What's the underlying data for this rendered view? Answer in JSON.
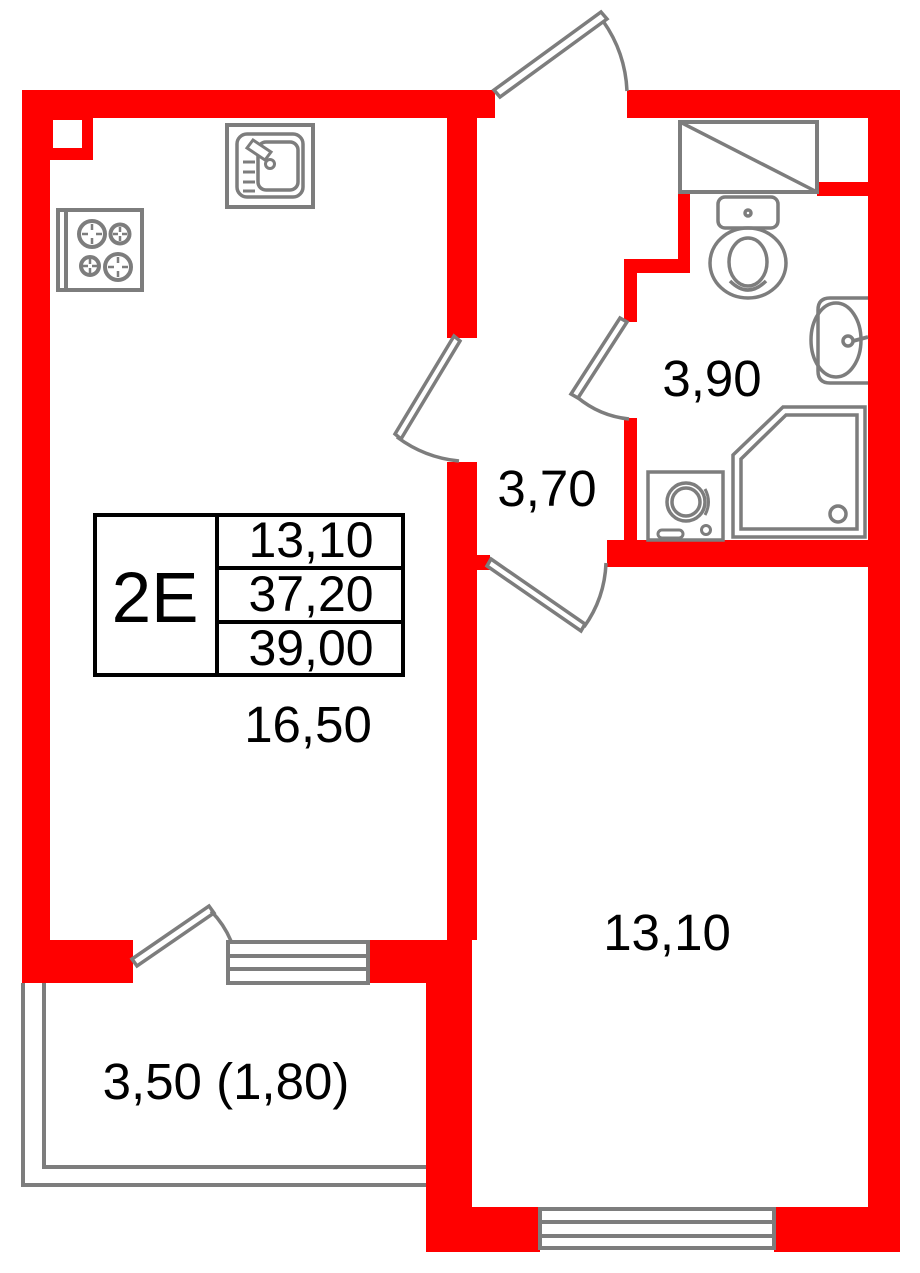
{
  "colors": {
    "wall": "#ff0000",
    "fixture": "#7d7d7d",
    "table_border": "#000000",
    "label": "#000000"
  },
  "unit_card": {
    "type": "2E",
    "values": [
      "13,10",
      "37,20",
      "39,00"
    ]
  },
  "rooms": {
    "kitchen_living": {
      "area": "16,50"
    },
    "hallway": {
      "area": "3,70"
    },
    "bathroom": {
      "area": "3,90"
    },
    "bedroom": {
      "area": "13,10"
    },
    "balcony": {
      "area": "3,50 (1,80)"
    }
  }
}
